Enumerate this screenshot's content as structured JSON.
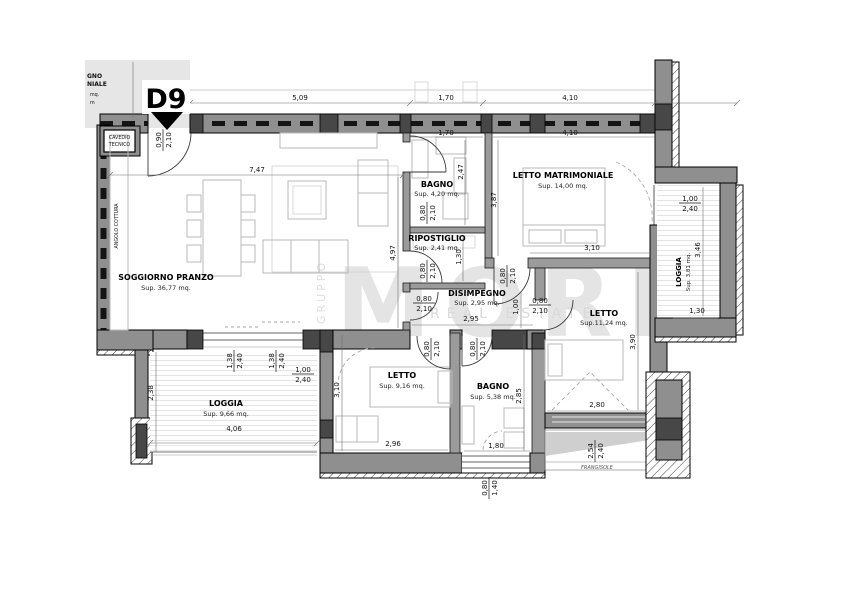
{
  "marker": "D9",
  "corner_legend": {
    "l1": "GNO",
    "l2": "NIALE",
    "l3": "mq.",
    "l4": "m"
  },
  "cavedio": {
    "l1": "CAVEDIO",
    "l2": "TECNICO"
  },
  "watermark": {
    "top": "GRUPPO",
    "main": "MORE",
    "sub": "REAL ESTATE"
  },
  "rooms": {
    "soggiorno": {
      "name": "SOGGIORNO PRANZO",
      "sup": "Sup. 36,77 mq."
    },
    "angolo": {
      "name": "ANGOLO COTTURA"
    },
    "bagno1": {
      "name": "BAGNO",
      "sup": "Sup. 4,20 mq."
    },
    "ripostiglio": {
      "name": "RIPOSTIGLIO",
      "sup": "Sup. 2,41 mq."
    },
    "disimpegno": {
      "name": "DISIMPEGNO",
      "sup": "Sup. 2,95 mq."
    },
    "letto_matrimoniale": {
      "name": "LETTO MATRIMONIALE",
      "sup": "Sup. 14,00 mq."
    },
    "letto2": {
      "name": "LETTO",
      "sup": "Sup.11,24 mq."
    },
    "letto3": {
      "name": "LETTO",
      "sup": "Sup. 9,16 mq."
    },
    "bagno2": {
      "name": "BAGNO",
      "sup": "Sup. 5,38 mq."
    },
    "loggia1": {
      "name": "LOGGIA",
      "sup": "Sup. 9,66 mq."
    },
    "loggia2": {
      "name": "LOGGIA",
      "sup": "Sup. 3,81 mq."
    },
    "frangisole": {
      "name": "FRANGISOLE"
    }
  },
  "dims": {
    "d509": "5,09",
    "d170": "1,70",
    "d410": "4,10",
    "d747": "7,47",
    "d497": "4,97",
    "d247": "2,47",
    "d130": "1,30",
    "d387": "3,87",
    "d310": "3,10",
    "d100": "1,00",
    "d295": "2,95",
    "d390": "3,90",
    "d280": "2,80",
    "d296": "2,96",
    "d285": "2,85",
    "d180": "1,80",
    "d238": "2,38",
    "d406": "4,06",
    "d346": "3,46"
  },
  "openings": {
    "entry": {
      "w": "0,90",
      "h": "2,10"
    },
    "door": {
      "w": "0,80",
      "h": "2,10"
    },
    "win138": {
      "w": "1,38",
      "h": "2,40"
    },
    "win100": {
      "w": "1,00",
      "h": "2,40"
    },
    "win080": {
      "w": "0,80",
      "h": "1,40"
    },
    "win254": {
      "w": "2,54",
      "h": "2,40"
    }
  }
}
